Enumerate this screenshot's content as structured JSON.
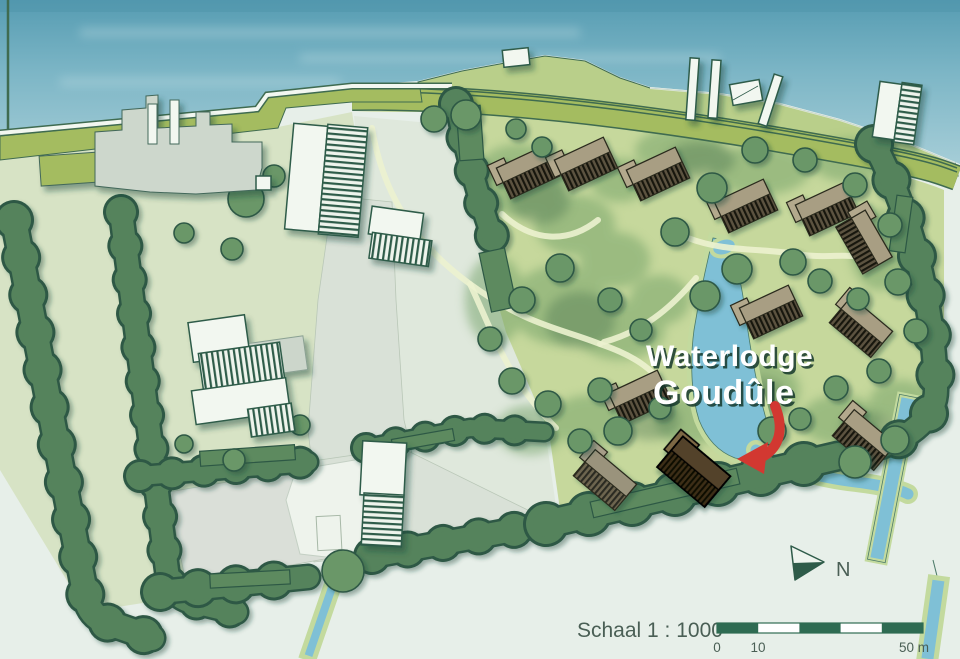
{
  "map": {
    "title_line1": "Waterlodge",
    "title_line2": "Goudûle",
    "scale_label": "Schaal 1 : 1000",
    "scale_tick_0": "0",
    "scale_tick_10": "10",
    "scale_tick_50": "50 m",
    "north_label": "N",
    "colors": {
      "water": "#7db6c6",
      "dike_grass": "#a4bc60",
      "field": "#d7e3c5",
      "park_grass": "#c6d89c",
      "tree": "#6a9768",
      "tree_outline": "#2d5845",
      "hedge": "#55835c",
      "building": "#f2f7f0",
      "building_outline": "#2e5b49",
      "lodge": "#a89e83",
      "highlight_lodge": "#53422a",
      "arrow_red": "#d23831",
      "scalebar_green": "#2e6b52",
      "label_text": "#4a5f55",
      "title_text": "#ffffff",
      "title_shadow": "#16382c"
    }
  }
}
